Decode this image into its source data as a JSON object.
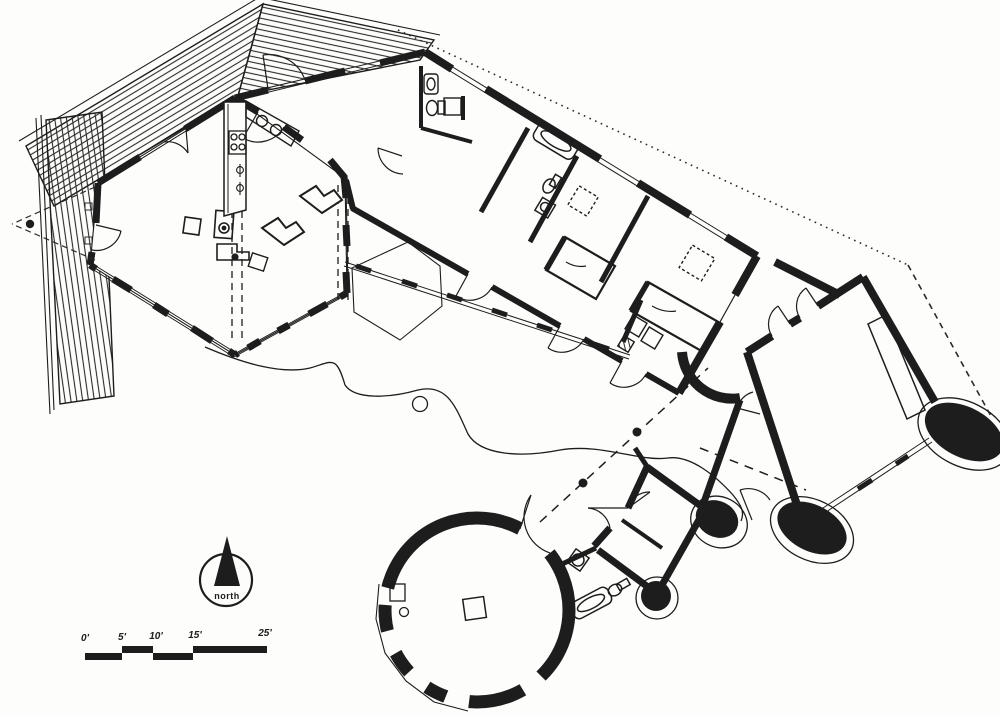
{
  "meta": {
    "drawing_type": "architectural floor plan",
    "view": "plan",
    "media": "black ink line drawing on white paper"
  },
  "colors": {
    "ink": "#1d1d1d",
    "paper": "#fdfdfb",
    "hatch": "#2a2a2a"
  },
  "compass": {
    "label": "north"
  },
  "scale_bar": {
    "unit": "feet",
    "tick_labels": [
      "0'",
      "5'",
      "10'",
      "15'",
      "25'"
    ],
    "tick_values": [
      0,
      5,
      10,
      15,
      25
    ]
  },
  "parts": {
    "pergola": "slatted trellis pergola over entry court",
    "living_room": "hexagonal living room",
    "kitchen": "galley kitchen with range and sink",
    "entry_bath": "entry vestibule with half bath",
    "bedroom_wing": "diagonal bedroom wing with bathroom and two bedrooms",
    "gallery": "glazed gallery wall",
    "terrace": "terrace with hexagonal deck and meandering garden edge",
    "studio": "rotated square studio room with curved masonry corners",
    "guest_suite": "guest suite with bathroom",
    "tower": "round tower room",
    "north_arrow": "north arrow",
    "scale_bar": "graphic scale bar"
  }
}
